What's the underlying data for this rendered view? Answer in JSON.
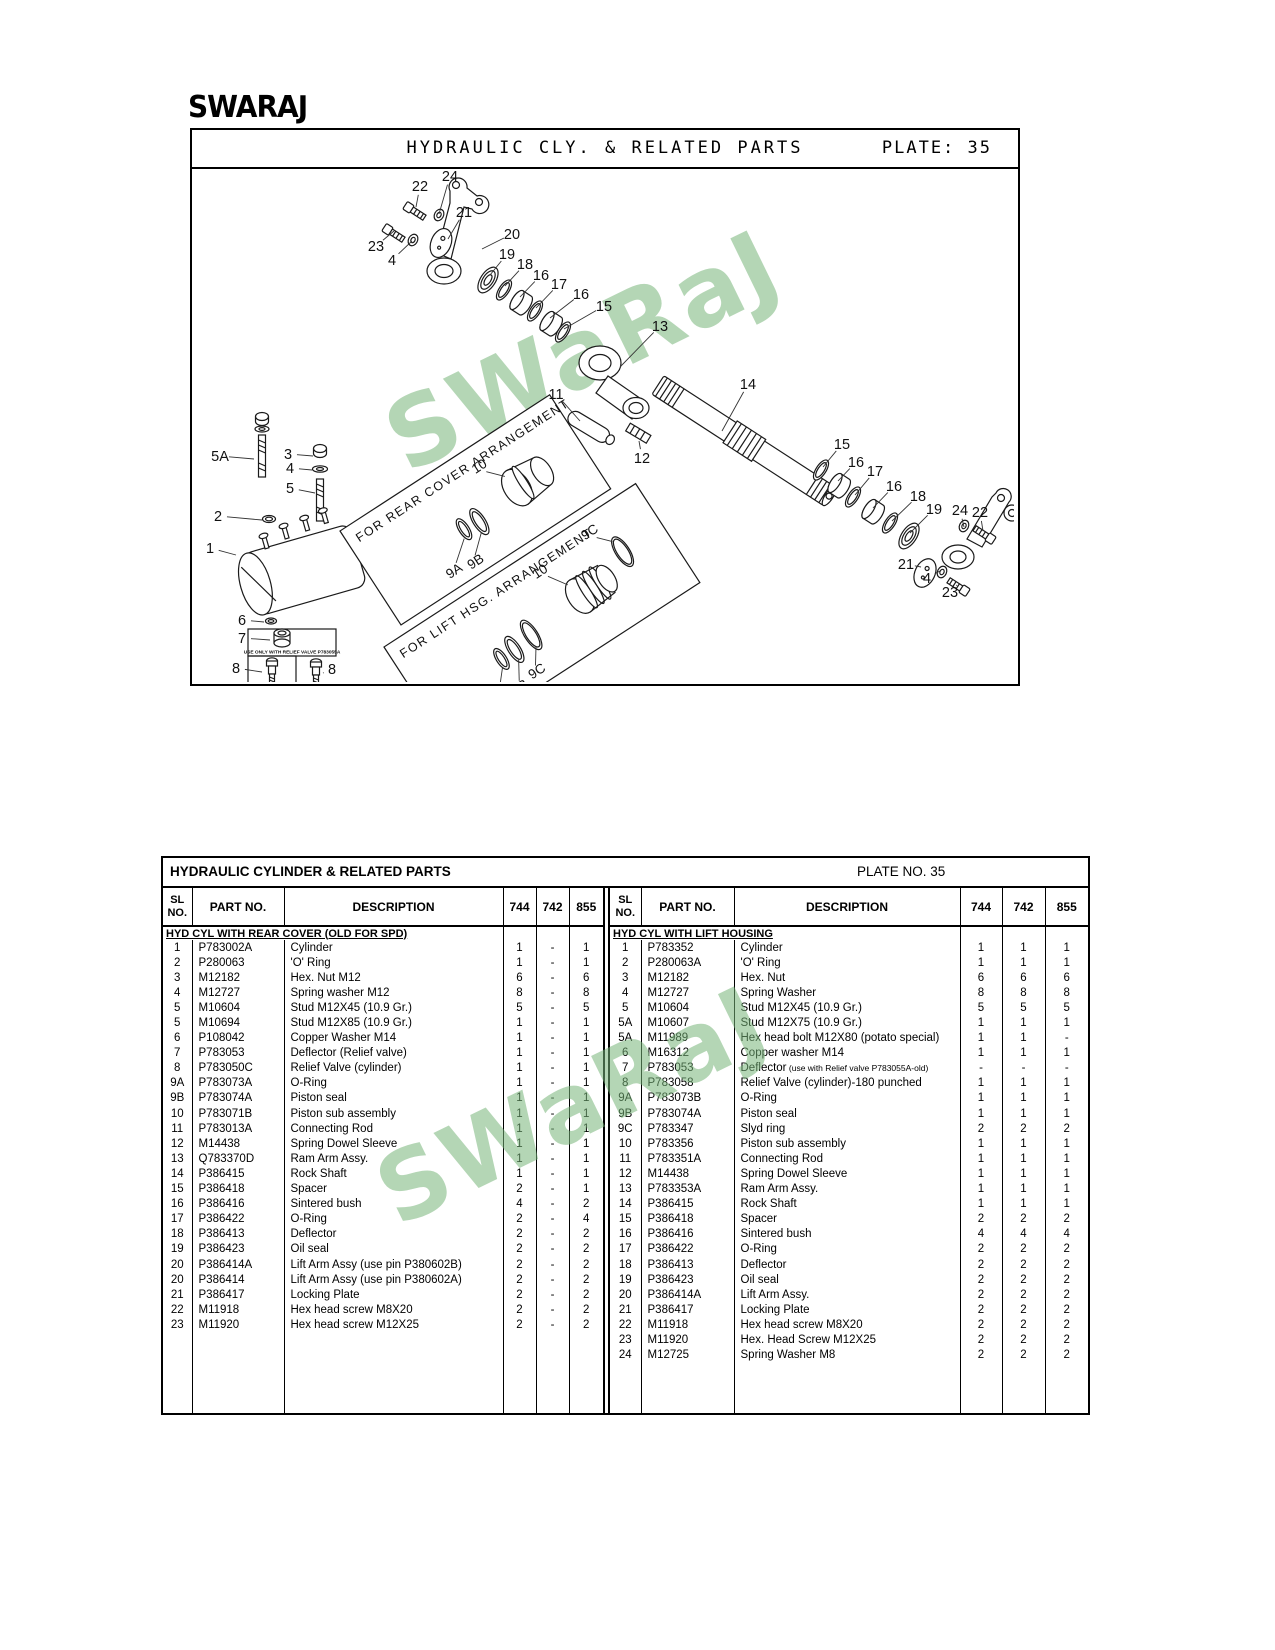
{
  "header": {
    "logo": "SWARAJ"
  },
  "plate_panel": {
    "title": "HYDRAULIC CLY. & RELATED PARTS",
    "plate": "PLATE: 35"
  },
  "diagram": {
    "watermark": "SWaRaJ",
    "note": "USE ONLY WITH RELIEF VALVE P783055A",
    "insets": [
      {
        "title": "FOR REAR COVER ARRANGEMENT",
        "l1": "9A",
        "l2": "9B",
        "l3": "10"
      },
      {
        "title": "FOR LIFT HSG. ARRANGEMENT",
        "l1": "9A",
        "l2": "9B",
        "l3": "9C",
        "l4": "10",
        "l5": "9C"
      }
    ],
    "labels": [
      [
        "22",
        228,
        22,
        224,
        38
      ],
      [
        "24",
        258,
        12,
        247,
        45
      ],
      [
        "21",
        272,
        48,
        256,
        70
      ],
      [
        "23",
        184,
        82,
        202,
        62
      ],
      [
        "4",
        200,
        96,
        220,
        72
      ],
      [
        "20",
        320,
        70,
        290,
        80
      ],
      [
        "19",
        315,
        90,
        298,
        106
      ],
      [
        "18",
        333,
        100,
        313,
        117
      ],
      [
        "16",
        349,
        111,
        328,
        128
      ],
      [
        "17",
        367,
        120,
        344,
        139
      ],
      [
        "16",
        389,
        130,
        358,
        149
      ],
      [
        "15",
        412,
        142,
        372,
        160
      ],
      [
        "13",
        468,
        162,
        428,
        198
      ],
      [
        "11",
        364,
        230,
        388,
        252
      ],
      [
        "14",
        556,
        220,
        530,
        262
      ],
      [
        "12",
        450,
        294,
        447,
        272
      ],
      [
        "15",
        650,
        280,
        631,
        298
      ],
      [
        "16",
        664,
        298,
        646,
        312
      ],
      [
        "17",
        683,
        307,
        663,
        326
      ],
      [
        "16",
        702,
        322,
        681,
        339
      ],
      [
        "18",
        726,
        332,
        700,
        352
      ],
      [
        "19",
        742,
        345,
        718,
        364
      ],
      [
        "24",
        768,
        346,
        772,
        358
      ],
      [
        "22",
        788,
        348,
        791,
        362
      ],
      [
        "21",
        714,
        400,
        729,
        398
      ],
      [
        "4",
        735,
        414,
        748,
        402
      ],
      [
        "23",
        758,
        428,
        765,
        416
      ],
      [
        "5A",
        28,
        292,
        62,
        290
      ],
      [
        "3",
        96,
        290,
        121,
        287
      ],
      [
        "4",
        98,
        304,
        120,
        301
      ],
      [
        "5",
        98,
        324,
        123,
        324
      ],
      [
        "2",
        26,
        352,
        70,
        351
      ],
      [
        "1",
        18,
        384,
        44,
        386
      ],
      [
        "6",
        50,
        456,
        72,
        453
      ],
      [
        "7",
        50,
        474,
        78,
        471
      ],
      [
        "8",
        44,
        504,
        70,
        503
      ],
      [
        "8",
        140,
        505,
        131,
        504
      ]
    ]
  },
  "table": {
    "title": "HYDRAULIC CYLINDER & RELATED PARTS",
    "plate": "PLATE NO. 35",
    "columns": [
      "SL NO.",
      "PART NO.",
      "DESCRIPTION",
      "744",
      "742",
      "855"
    ],
    "left": {
      "section": "HYD CYL WITH REAR COVER (OLD FOR SPD)",
      "rows": [
        [
          "1",
          "P783002A",
          "Cylinder",
          "1",
          "-",
          "1"
        ],
        [
          "2",
          "P280063",
          "'O' Ring",
          "1",
          "-",
          "1"
        ],
        [
          "3",
          "M12182",
          "Hex. Nut M12",
          "6",
          "-",
          "6"
        ],
        [
          "4",
          "M12727",
          "Spring washer M12",
          "8",
          "-",
          "8"
        ],
        [
          "5",
          "M10604",
          "Stud M12X45 (10.9 Gr.)",
          "5",
          "-",
          "5"
        ],
        [
          "5",
          "M10694",
          "Stud M12X85 (10.9 Gr.)",
          "1",
          "-",
          "1"
        ],
        [
          "6",
          "P108042",
          "Copper Washer M14",
          "1",
          "-",
          "1"
        ],
        [
          "7",
          "P783053",
          "Deflector (Relief valve)",
          "1",
          "-",
          "1"
        ],
        [
          "8",
          "P783050C",
          "Relief Valve (cylinder)",
          "1",
          "-",
          "1"
        ],
        [
          "9A",
          "P783073A",
          "O-Ring",
          "1",
          "-",
          "1"
        ],
        [
          "9B",
          "P783074A",
          "Piston seal",
          "1",
          "-",
          "1"
        ],
        [
          "10",
          "P783071B",
          "Piston sub assembly",
          "1",
          "-",
          "1"
        ],
        [
          "11",
          "P783013A",
          "Connecting Rod",
          "1",
          "-",
          "1"
        ],
        [
          "12",
          "M14438",
          "Spring Dowel Sleeve",
          "1",
          "-",
          "1"
        ],
        [
          "13",
          "Q783370D",
          "Ram Arm Assy.",
          "1",
          "-",
          "1"
        ],
        [
          "14",
          "P386415",
          "Rock Shaft",
          "1",
          "-",
          "1"
        ],
        [
          "15",
          "P386418",
          "Spacer",
          "2",
          "-",
          "1"
        ],
        [
          "16",
          "P386416",
          "Sintered bush",
          "4",
          "-",
          "2"
        ],
        [
          "17",
          "P386422",
          "O-Ring",
          "2",
          "-",
          "4"
        ],
        [
          "18",
          "P386413",
          "Deflector",
          "2",
          "-",
          "2"
        ],
        [
          "19",
          "P386423",
          "Oil seal",
          "2",
          "-",
          "2"
        ],
        [
          "20",
          "P386414A",
          "Lift Arm Assy (use pin P380602B)",
          "2",
          "-",
          "2"
        ],
        [
          "20",
          "P386414",
          "Lift Arm Assy (use pin P380602A)",
          "2",
          "-",
          "2"
        ],
        [
          "21",
          "P386417",
          "Locking Plate",
          "2",
          "-",
          "2"
        ],
        [
          "22",
          "M11918",
          "Hex head screw M8X20",
          "2",
          "-",
          "2"
        ],
        [
          "23",
          "M11920",
          "Hex head screw M12X25",
          "2",
          "-",
          "2"
        ]
      ]
    },
    "right": {
      "section": "HYD CYL WITH LIFT HOUSING",
      "rows": [
        [
          "1",
          "P783352",
          "Cylinder",
          "1",
          "1",
          "1"
        ],
        [
          "2",
          "P280063A",
          "'O' Ring",
          "1",
          "1",
          "1"
        ],
        [
          "3",
          "M12182",
          "Hex. Nut",
          "6",
          "6",
          "6"
        ],
        [
          "4",
          "M12727",
          "Spring Washer",
          "8",
          "8",
          "8"
        ],
        [
          "5",
          "M10604",
          "Stud M12X45 (10.9 Gr.)",
          "5",
          "5",
          "5"
        ],
        [
          "5A",
          "M10607",
          "Stud M12X75 (10.9 Gr.)",
          "1",
          "1",
          "1"
        ],
        [
          "5A",
          "M11989",
          "Hex head bolt M12X80 (potato special)",
          "1",
          "1",
          "-"
        ],
        [
          "6",
          "M16312",
          "Copper washer M14",
          "1",
          "1",
          "1"
        ],
        [
          "7",
          "P783053",
          "Deflector",
          "-",
          "-",
          "-",
          "(use with Relief valve P783055A-old)"
        ],
        [
          "8",
          "P783058",
          "Relief Valve (cylinder)-180 punched",
          "1",
          "1",
          "1"
        ],
        [
          "9A",
          "P783073B",
          "O-Ring",
          "1",
          "1",
          "1"
        ],
        [
          "9B",
          "P783074A",
          "Piston seal",
          "1",
          "1",
          "1"
        ],
        [
          "9C",
          "P783347",
          "Slyd ring",
          "2",
          "2",
          "2"
        ],
        [
          "10",
          "P783356",
          "Piston sub assembly",
          "1",
          "1",
          "1"
        ],
        [
          "11",
          "P783351A",
          "Connecting Rod",
          "1",
          "1",
          "1"
        ],
        [
          "12",
          "M14438",
          "Spring Dowel Sleeve",
          "1",
          "1",
          "1"
        ],
        [
          "13",
          "P783353A",
          "Ram Arm Assy.",
          "1",
          "1",
          "1"
        ],
        [
          "14",
          "P386415",
          "Rock Shaft",
          "1",
          "1",
          "1"
        ],
        [
          "15",
          "P386418",
          "Spacer",
          "2",
          "2",
          "2"
        ],
        [
          "16",
          "P386416",
          "Sintered bush",
          "4",
          "4",
          "4"
        ],
        [
          "17",
          "P386422",
          "O-Ring",
          "2",
          "2",
          "2"
        ],
        [
          "18",
          "P386413",
          "Deflector",
          "2",
          "2",
          "2"
        ],
        [
          "19",
          "P386423",
          "Oil seal",
          "2",
          "2",
          "2"
        ],
        [
          "20",
          "P386414A",
          "Lift Arm Assy.",
          "2",
          "2",
          "2"
        ],
        [
          "21",
          "P386417",
          "Locking Plate",
          "2",
          "2",
          "2"
        ],
        [
          "22",
          "M11918",
          "Hex head screw M8X20",
          "2",
          "2",
          "2"
        ],
        [
          "23",
          "M11920",
          "Hex. Head Screw M12X25",
          "2",
          "2",
          "2"
        ],
        [
          "24",
          "M12725",
          "Spring Washer M8",
          "2",
          "2",
          "2"
        ]
      ]
    }
  }
}
